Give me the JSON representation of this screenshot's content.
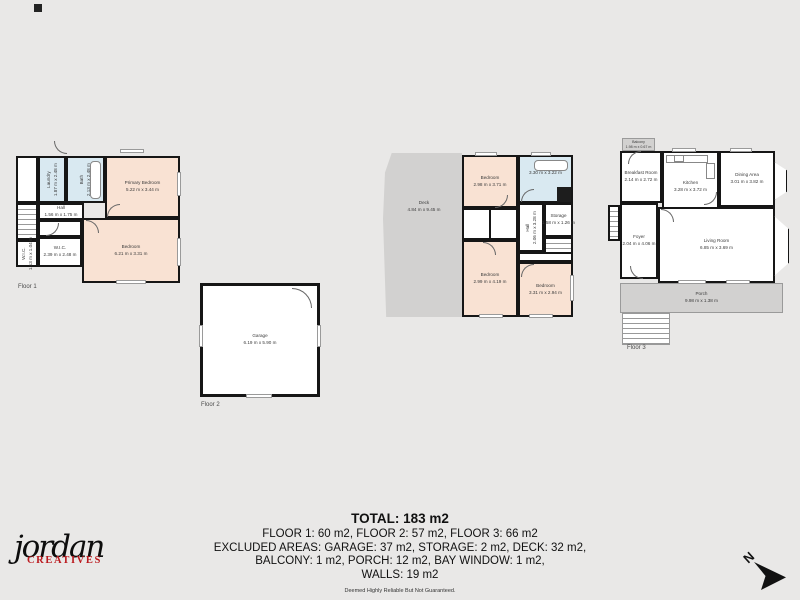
{
  "colors": {
    "background": "#e9e8e7",
    "wall": "#161616",
    "bedroom_fill": "#f9e2d3",
    "wet_room_fill": "#d9e9f1",
    "outdoor_fill": "#d2d1d0",
    "logo_red": "#bb1a1f"
  },
  "plans": {
    "floor1": {
      "caption": "Floor 1",
      "rooms": {
        "laundry": {
          "name": "Laundry",
          "dims": "1.87 m x 2.48 m"
        },
        "bath": {
          "name": "Bath",
          "dims": "2.13 m x 2.48 m"
        },
        "primary_bedroom": {
          "name": "Primary Bedroom",
          "dims": "5.22 m x 3.44 m"
        },
        "hall": {
          "name": "Hall",
          "dims": "1.56 m x 1.75 m"
        },
        "bedroom": {
          "name": "Bedroom",
          "dims": "6.21 m x 3.31 m"
        },
        "wic_small": {
          "name": "W.I.C.",
          "dims": "1.13 m x 1.04 m"
        },
        "wic": {
          "name": "W.I.C.",
          "dims": "2.39 m x 2.48 m"
        }
      }
    },
    "floor2": {
      "caption": "Floor 2",
      "rooms": {
        "garage": {
          "name": "Garage",
          "dims": "6.19 m x 5.90 m"
        }
      }
    },
    "floor2_upper": {
      "rooms": {
        "deck": {
          "name": "Deck",
          "dims": "4.84 m x 9.45 m"
        },
        "bedroom1": {
          "name": "Bedroom",
          "dims": "2.98 m x 3.71 m"
        },
        "bath": {
          "name": "Bath",
          "dims": "3.30 m x 3.22 m"
        },
        "hall": {
          "name": "Hall",
          "dims": "2.06 m x 3.28 m"
        },
        "storage": {
          "name": "Storage",
          "dims": "1.58 m x 1.26 m"
        },
        "bedroom2": {
          "name": "Bedroom",
          "dims": "2.99 m x 4.19 m"
        },
        "bedroom3": {
          "name": "Bedroom",
          "dims": "3.31 m x 2.94 m"
        }
      }
    },
    "floor3": {
      "caption": "Floor 3",
      "rooms": {
        "balcony": {
          "name": "Balcony",
          "dims": "1.98 m x 0.67 m"
        },
        "breakfast": {
          "name": "Breakfast Room",
          "dims": "2.14 m x 2.72 m"
        },
        "kitchen": {
          "name": "Kitchen",
          "dims": "3.28 m x 3.72 m"
        },
        "dining": {
          "name": "Dining Area",
          "dims": "3.01 m x 3.82 m"
        },
        "foyer": {
          "name": "Foyer",
          "dims": "2.04 m x 4.06 m"
        },
        "living": {
          "name": "Living Room",
          "dims": "6.85 m x 3.69 m"
        },
        "porch": {
          "name": "Porch",
          "dims": "9.98 m x 1.38 m"
        }
      }
    }
  },
  "summary": {
    "total": "TOTAL: 183 m2",
    "line1": "FLOOR 1: 60 m2, FLOOR 2: 57 m2, FLOOR 3: 66 m2",
    "line2": "EXCLUDED AREAS: GARAGE: 37 m2, STORAGE: 2 m2, DECK: 32 m2,",
    "line3": "BALCONY: 1 m2, PORCH: 12 m2, BAY WINDOW: 1 m2,",
    "line4": "WALLS: 19 m2",
    "disclaimer": "Deemed Highly Reliable But Not Guaranteed."
  },
  "logo": {
    "name": "jordan",
    "sub": "CREATIVES"
  },
  "compass": {
    "label": "N"
  }
}
